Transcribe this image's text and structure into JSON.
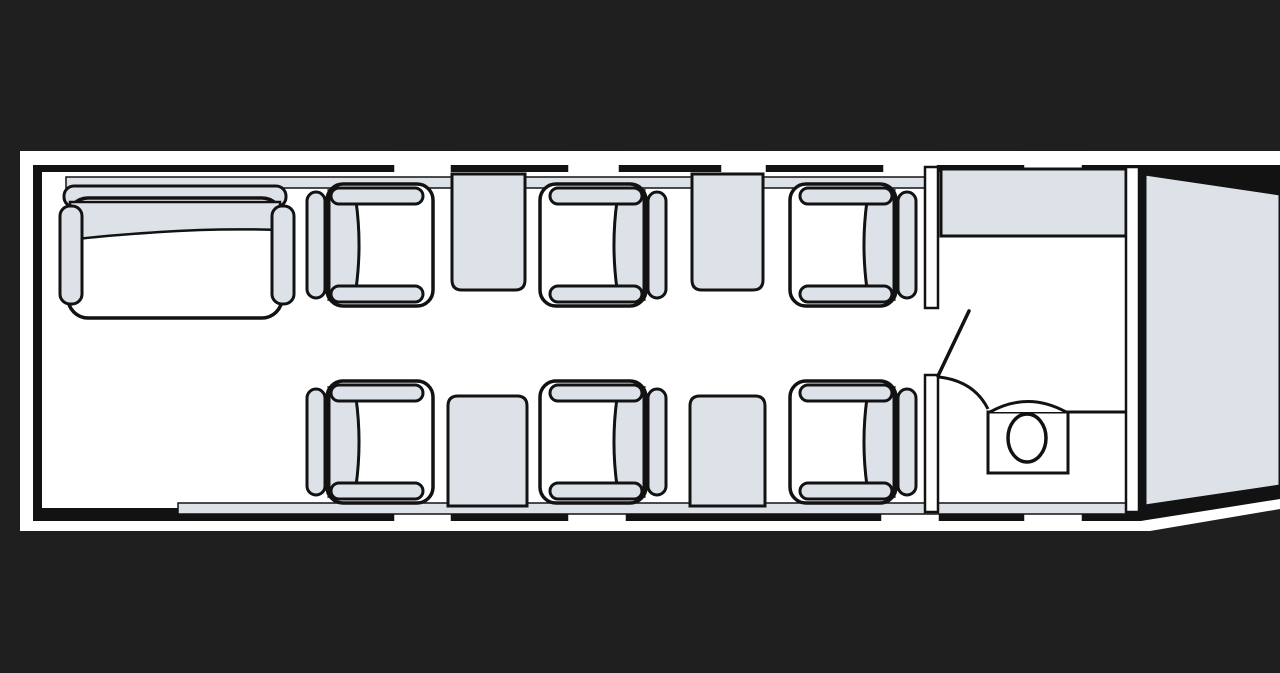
{
  "diagram": {
    "type": "aircraft-cabin-floorplan",
    "description": "Top-down seat map of a midsize business jet cabin, forward section at left, aft baggage at right",
    "orientation": "nose-left-tail-right"
  },
  "colors": {
    "background": "#201f20",
    "outline": "#121212",
    "hull_white": "#fdfdfd",
    "cabin_floor": "#ffffff",
    "fixture_gray": "#dde2e9"
  },
  "furniture": {
    "divan": {
      "name": "forward-divan",
      "seats": 2,
      "position": "forward-left",
      "x": 60,
      "y": 186
    },
    "club_seats": [
      {
        "id": "seat-1A",
        "row": "top",
        "order": 1,
        "facing": "aft",
        "x": 433,
        "y": 184,
        "mirror": true
      },
      {
        "id": "seat-2A",
        "row": "top",
        "order": 2,
        "facing": "forward",
        "x": 540,
        "y": 184,
        "mirror": false
      },
      {
        "id": "seat-3A",
        "row": "top",
        "order": 3,
        "facing": "forward",
        "x": 790,
        "y": 184,
        "mirror": false
      },
      {
        "id": "seat-1B",
        "row": "bottom",
        "order": 1,
        "facing": "aft",
        "x": 433,
        "y": 381,
        "mirror": true
      },
      {
        "id": "seat-2B",
        "row": "bottom",
        "order": 2,
        "facing": "forward",
        "x": 540,
        "y": 381,
        "mirror": false
      },
      {
        "id": "seat-3B",
        "row": "bottom",
        "order": 3,
        "facing": "forward",
        "x": 790,
        "y": 381,
        "mirror": false
      }
    ],
    "side_tables": [
      {
        "id": "table-top-1",
        "wall": "top",
        "x": 452,
        "w": 73
      },
      {
        "id": "table-top-2",
        "wall": "top",
        "x": 692,
        "w": 71
      },
      {
        "id": "table-bottom-1",
        "wall": "bottom",
        "x": 448,
        "w": 79
      },
      {
        "id": "table-bottom-2",
        "wall": "bottom",
        "x": 690,
        "w": 75
      }
    ],
    "galley_cabinet": {
      "position": "aft-top",
      "x": 941,
      "y": 169,
      "w": 185,
      "h": 67
    },
    "lavatory": {
      "position": "aft",
      "toilet": true,
      "door_state": "open"
    },
    "baggage_compartment": {
      "position": "tail"
    }
  },
  "windows": {
    "top": [
      {
        "x": 393,
        "w": 59
      },
      {
        "x": 567,
        "w": 53
      },
      {
        "x": 720,
        "w": 47
      },
      {
        "x": 882,
        "w": 56
      },
      {
        "x": 1023,
        "w": 60
      }
    ],
    "bottom": [
      {
        "x": 393,
        "w": 59
      },
      {
        "x": 567,
        "w": 60
      },
      {
        "x": 880,
        "w": 60
      },
      {
        "x": 1023,
        "w": 60
      }
    ]
  },
  "seat_totals": {
    "club_seats": 6,
    "divan_seats": 2,
    "total_passengers": 8
  }
}
